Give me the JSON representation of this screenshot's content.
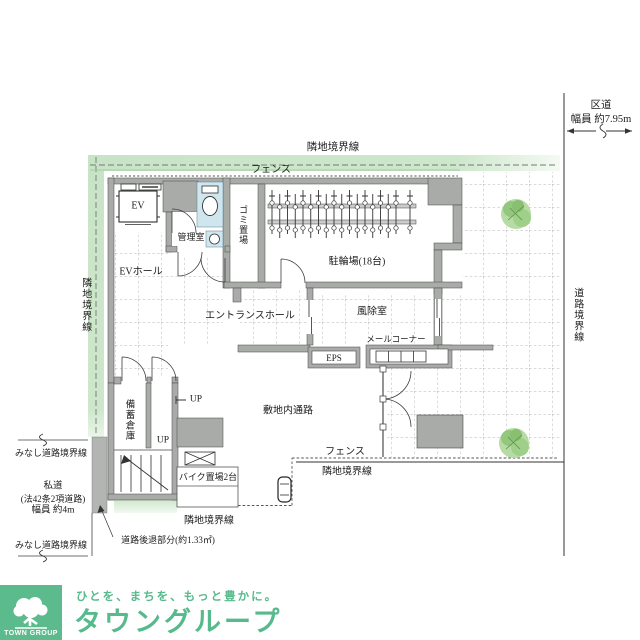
{
  "colors": {
    "brand_green": "#57ba8c",
    "boundary_band_green": "#c8e4c6",
    "wall_gray": "#a9aba9",
    "toilet_blue": "#cfe6ef"
  },
  "icons": {
    "trees": "tree-icon",
    "toilet": "toilet-icon",
    "sink": "sink-icon",
    "bicycles": "bicycle-icon",
    "motorcycle": "motorcycle-icon",
    "elevator": "elevator-icon",
    "stairs": "stairs-icon",
    "mailboxes": "mailboxes-icon",
    "logo_tree": "tree-logo-icon"
  },
  "plan": {
    "boundary": {
      "top": "隣地境界線",
      "left": "隣地境界線",
      "right": "道路境界線",
      "bottom_right": "隣地境界線",
      "bottom_left": "隣地境界線",
      "fence_top": "フェンス",
      "fence_bottom": "フェンス",
      "deemed_top": "みなし道路境界線",
      "deemed_bottom": "みなし道路境界線"
    },
    "road": {
      "name": "区道",
      "width": "幅員 約7.95m"
    },
    "private_road": {
      "name": "私道",
      "law": "(法42条2項道路)",
      "width": "幅員 約4m"
    },
    "setback": "道路後退部分(約1.33㎡)",
    "rooms": {
      "ev": "EV",
      "ev_hall": "EVホール",
      "manager": "管理室",
      "garbage": "ゴミ置場",
      "bicycle": "駐輪場(18台)",
      "entrance": "エントランスホール",
      "windbreak": "風除室",
      "mail": "メールコーナー",
      "eps": "EPS",
      "passage": "敷地内通路",
      "storage": "備蓄倉庫",
      "bike": "バイク置場2台",
      "up_a": "UP",
      "up_b": "UP"
    }
  },
  "footer": {
    "logo": "TOWN GROUP",
    "tagline": "ひとを、まちを、もっと豊かに。",
    "brand": "タウングループ"
  }
}
